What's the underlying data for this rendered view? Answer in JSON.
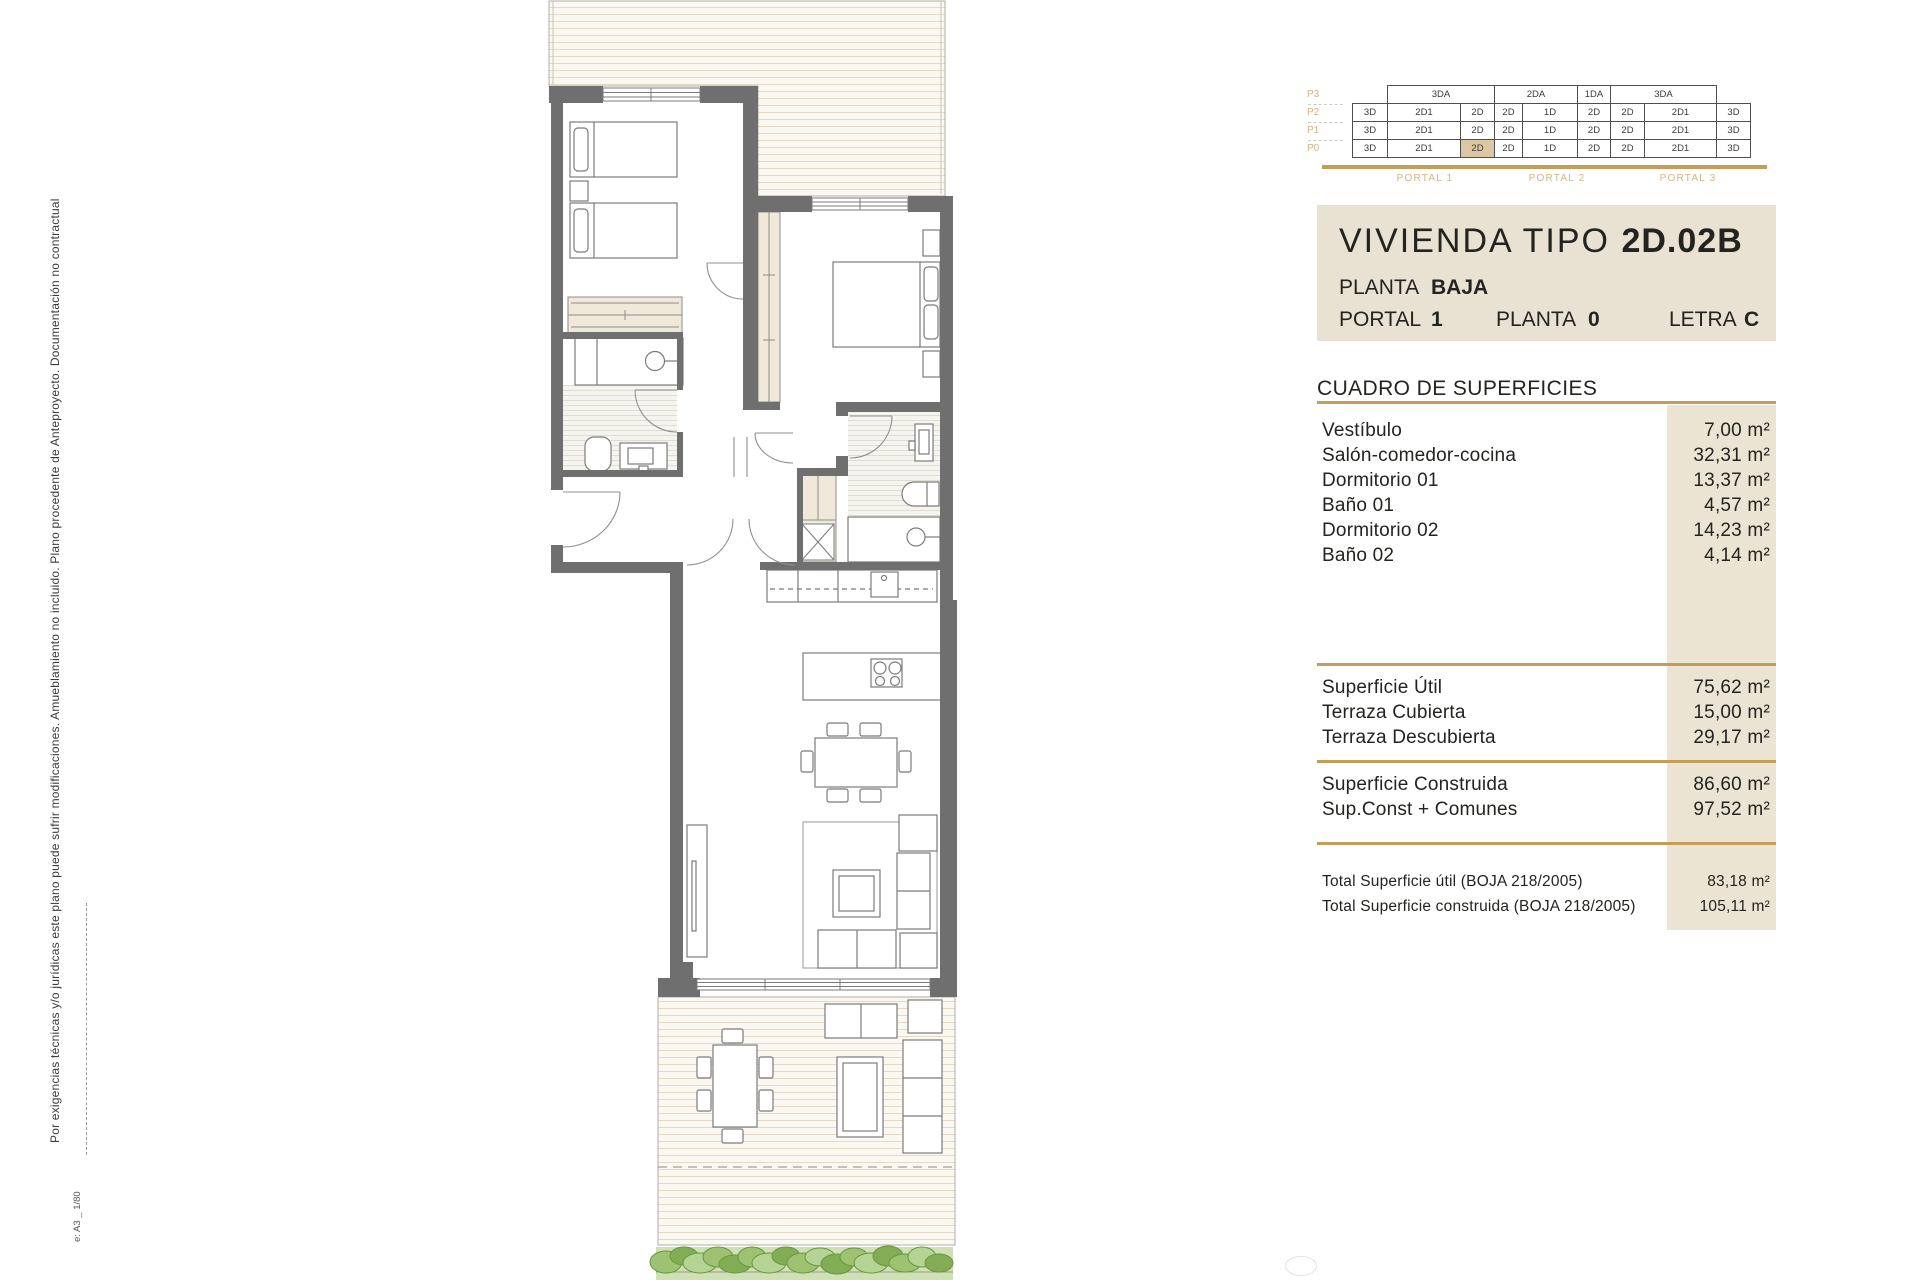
{
  "colors": {
    "gold": "#c49d56",
    "tan_label": "#d3b583",
    "panel_beige": "#e9e1d2",
    "column_beige": "#ece4d3",
    "highlight_cell": "#dcc7a5",
    "wall_gray": "#6f6f6f"
  },
  "side_note": {
    "text": "Por exigencias técnicas y/o jurídicas este plano puede sufrir modificaciones. Amueblamiento no incluido. Plano procedente de Anteproyecto. Documentación no contractual",
    "scale": "e: A3 _ 1/80"
  },
  "unit_matrix": {
    "row_labels": [
      "P3",
      "P2",
      "P1",
      "P0"
    ],
    "p3": [
      {
        "label": "3DA",
        "span": [
          1,
          2
        ]
      },
      {
        "label": "2DA",
        "span": [
          3,
          4
        ]
      },
      {
        "label": "1DA",
        "span": [
          5
        ]
      },
      {
        "label": "3DA",
        "span": [
          6,
          7
        ]
      }
    ],
    "rows": [
      [
        "3D",
        "2D1",
        "2D",
        "2D",
        "1D",
        "2D",
        "2D",
        "2D1",
        "3D"
      ],
      [
        "3D",
        "2D1",
        "2D",
        "2D",
        "1D",
        "2D",
        "2D",
        "2D1",
        "3D"
      ],
      [
        "3D",
        "2D1",
        "2D",
        "2D",
        "1D",
        "2D",
        "2D",
        "2D1",
        "3D"
      ]
    ],
    "highlight": {
      "row": "P0",
      "col": 2
    },
    "portal_labels": [
      "PORTAL 1",
      "PORTAL 2",
      "PORTAL 3"
    ]
  },
  "title_block": {
    "name": "VIVIENDA TIPO",
    "code": "2D.02B",
    "planta_label": "PLANTA",
    "planta_value": "BAJA",
    "fields": [
      {
        "label": "PORTAL",
        "value": "1"
      },
      {
        "label": "PLANTA",
        "value": "0"
      },
      {
        "label": "LETRA",
        "value": "C"
      }
    ]
  },
  "surfaces": {
    "header": "CUADRO DE SUPERFICIES",
    "rooms": [
      {
        "name": "Vestíbulo",
        "area": "7,00 m²"
      },
      {
        "name": "Salón-comedor-cocina",
        "area": "32,31 m²"
      },
      {
        "name": "Dormitorio 01",
        "area": "13,37 m²"
      },
      {
        "name": "Baño 01",
        "area": "4,57 m²"
      },
      {
        "name": "Dormitorio 02",
        "area": "14,23 m²"
      },
      {
        "name": "Baño 02",
        "area": "4,14 m²"
      }
    ],
    "utiles": [
      {
        "name": "Superficie Útil",
        "area": "75,62 m²"
      },
      {
        "name": "Terraza Cubierta",
        "area": "15,00 m²"
      },
      {
        "name": "Terraza Descubierta",
        "area": "29,17 m²"
      }
    ],
    "construida": [
      {
        "name": "Superficie Construida",
        "area": "86,60 m²"
      },
      {
        "name": "Sup.Const + Comunes",
        "area": "97,52 m²"
      }
    ],
    "totals": [
      {
        "name": "Total Superficie útil (BOJA 218/2005)",
        "area": "83,18 m²"
      },
      {
        "name": "Total Superficie construida (BOJA 218/2005)",
        "area": "105,11 m²"
      }
    ]
  }
}
